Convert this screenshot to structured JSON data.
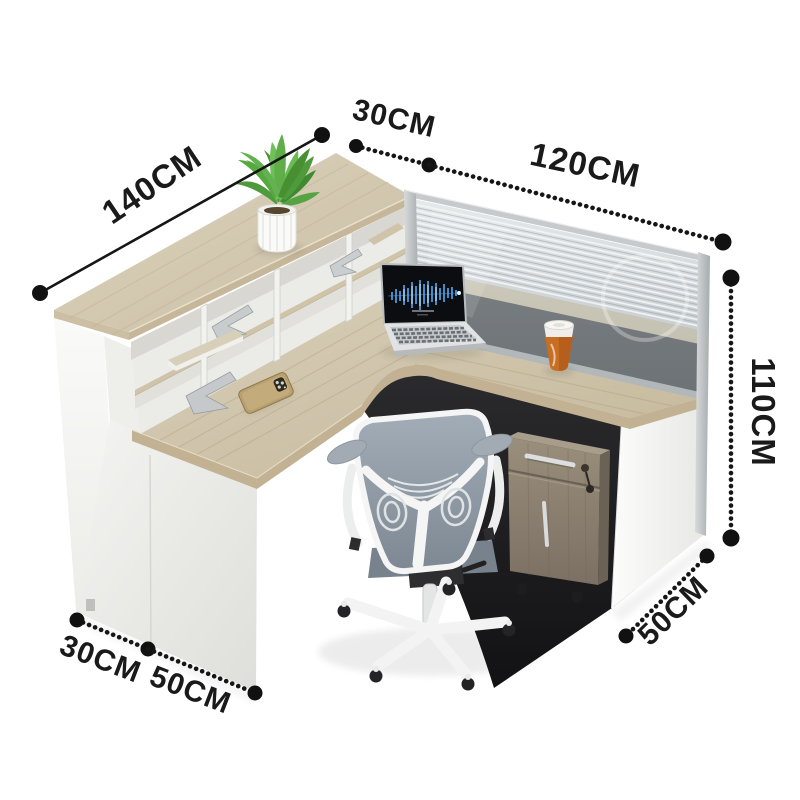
{
  "scene": {
    "kind": "product-dimension-image",
    "subject": "L-shaped office reception desk workstation with louvered privacy screen"
  },
  "dimensions": {
    "counter_length": "140CM",
    "hutch_depth": "30CM",
    "return_desk_length": "120CM",
    "overall_height": "110CM",
    "return_desk_depth": "50CM",
    "end_depth_hutch": "30CM",
    "end_depth_desk": "50CM"
  },
  "objects": [
    "potted-plant",
    "reception-counter",
    "cubby-hutch",
    "louvered-privacy-screen",
    "laptop-with-audio-waveform",
    "smartphone",
    "coffee-cup",
    "office-mesh-chair",
    "mobile-pedestal-cabinet"
  ],
  "colors": {
    "background": "#ffffff",
    "desk_wood": "#cfc3a8",
    "panel_white": "#f2f2ef",
    "screen_glass": "#ccd3d6",
    "pedestal_wood": "#8d8273",
    "cup_orange": "#c86e22",
    "plant_green": "#5fae4a",
    "chair_mesh": "#97a1ac",
    "annotation_ink": "#1a1a1a"
  }
}
